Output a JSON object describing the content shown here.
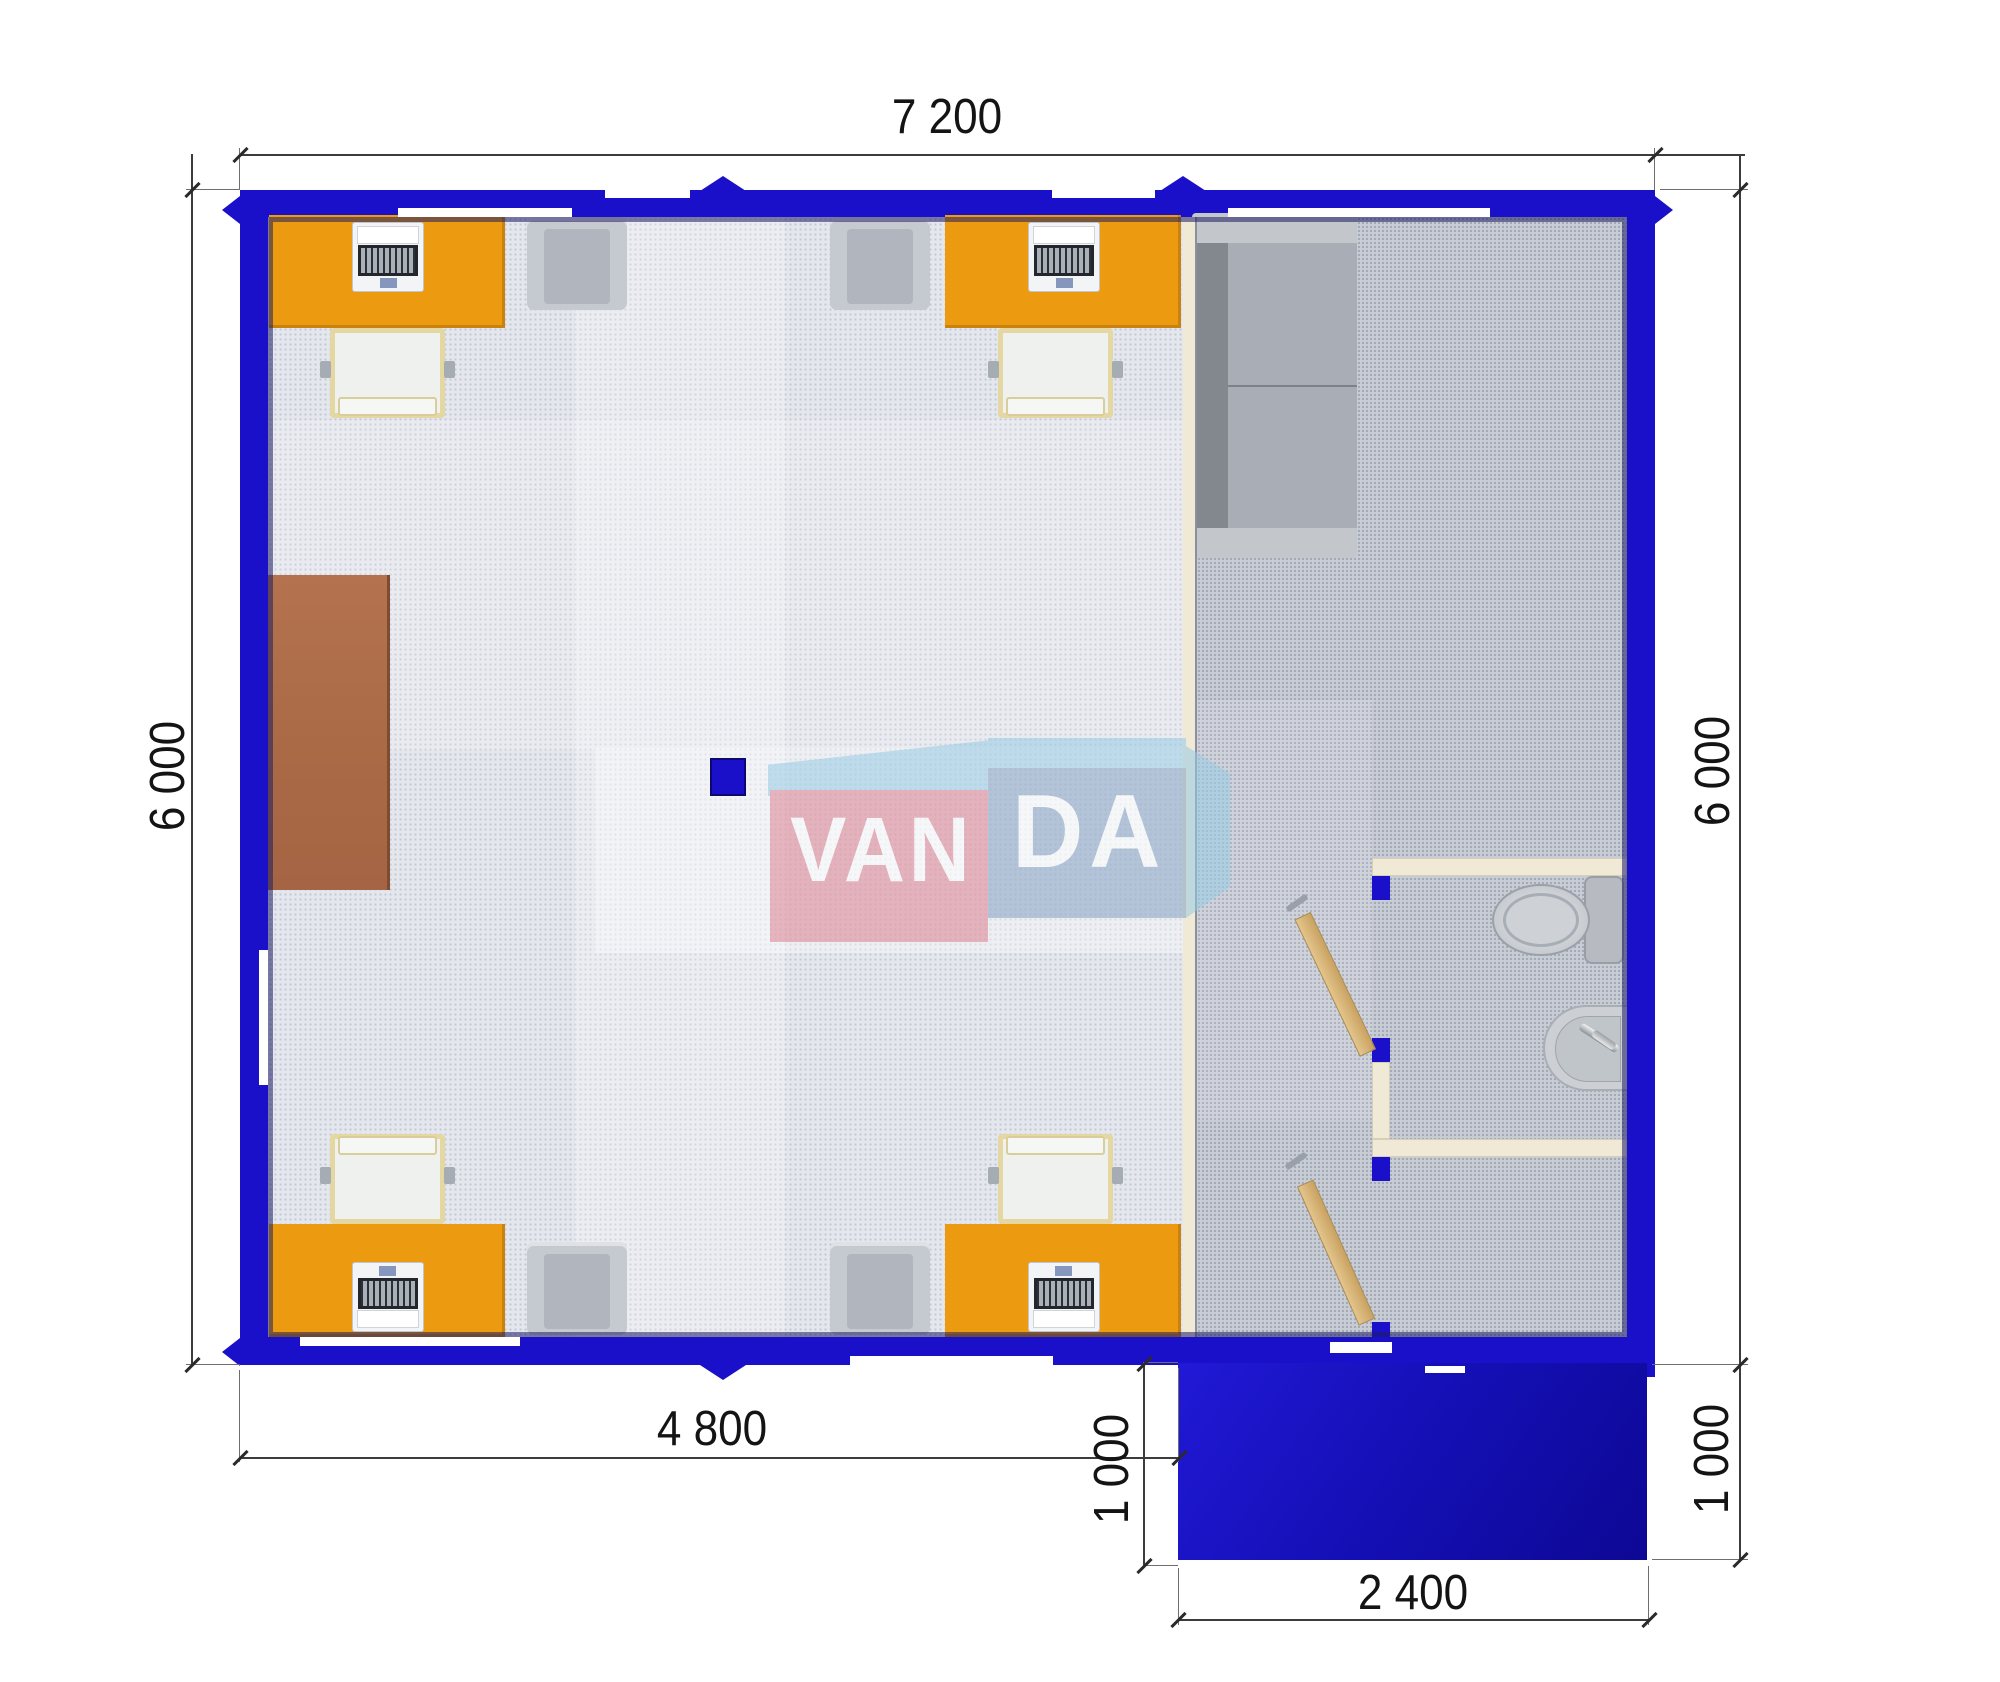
{
  "watermark": {
    "part1": "VAN",
    "part2": "DA"
  },
  "dimensions": {
    "top": "7 200",
    "left": "6 000",
    "right": "6 000",
    "bottom_office": "4 800",
    "porch_left": "1 000",
    "porch_right": "1 000",
    "porch_bottom": "2 400"
  },
  "colors": {
    "wall_blue": "#1B10C9",
    "wall_inner_shadow": "#1C1C64",
    "partition_cream": "#F0E9D5",
    "desk_orange": "#EC9B10",
    "cabinet_brown": "#AF6F4B",
    "door_wood": "#D9B87C",
    "floor_office": "#E4E7ED",
    "floor_annex": "#C8CCD5",
    "porch_blue": "#1510B8",
    "sofa_gray": "#A9AEB6",
    "armchair_gray": "#C5C9D0",
    "office_chair_white": "#EFF1EF",
    "logo_pink": "#DE8191",
    "logo_steel_blue": "#85A0C2",
    "logo_light_blue": "#96CBE4"
  },
  "furniture": {
    "desks": 4,
    "laptops": 4,
    "office_chairs": 4,
    "armchairs": 4,
    "sofas": 1,
    "cabinets": 1,
    "toilets": 1,
    "sinks": 1,
    "interior_doors": 2
  }
}
